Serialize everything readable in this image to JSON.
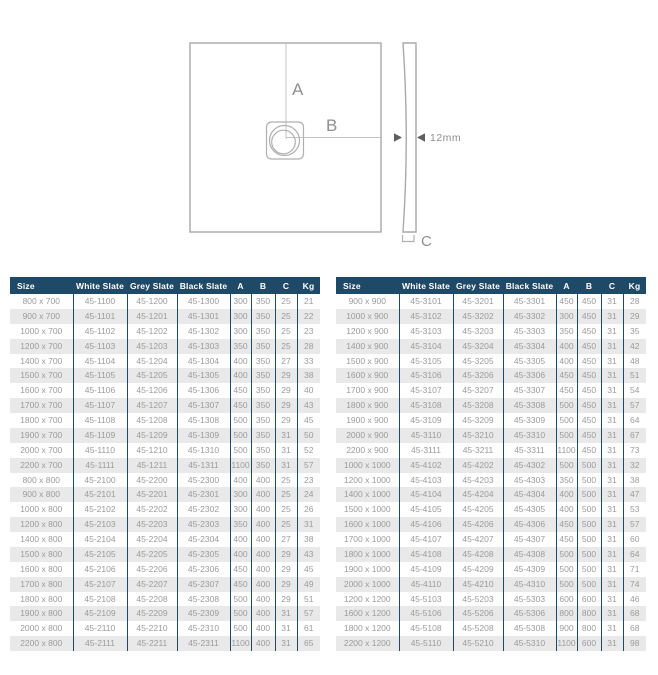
{
  "diagram": {
    "labels": {
      "a": "A",
      "b": "B",
      "c": "C",
      "thickness": "12mm"
    }
  },
  "columns": [
    "Size",
    "White Slate",
    "Grey Slate",
    "Black Slate",
    "A",
    "B",
    "C",
    "Kg"
  ],
  "tables": [
    {
      "id": "table-left",
      "rows": [
        [
          "800 x 700",
          "45-1100",
          "45-1200",
          "45-1300",
          "300",
          "350",
          "25",
          "21"
        ],
        [
          "900 x 700",
          "45-1101",
          "45-1201",
          "45-1301",
          "300",
          "350",
          "25",
          "22"
        ],
        [
          "1000 x 700",
          "45-1102",
          "45-1202",
          "45-1302",
          "300",
          "350",
          "25",
          "23"
        ],
        [
          "1200 x 700",
          "45-1103",
          "45-1203",
          "45-1303",
          "350",
          "350",
          "25",
          "28"
        ],
        [
          "1400 x 700",
          "45-1104",
          "45-1204",
          "45-1304",
          "400",
          "350",
          "27",
          "33"
        ],
        [
          "1500 x 700",
          "45-1105",
          "45-1205",
          "45-1305",
          "400",
          "350",
          "29",
          "38"
        ],
        [
          "1600 x 700",
          "45-1106",
          "45-1206",
          "45-1306",
          "450",
          "350",
          "29",
          "40"
        ],
        [
          "1700 x 700",
          "45-1107",
          "45-1207",
          "45-1307",
          "450",
          "350",
          "29",
          "43"
        ],
        [
          "1800 x 700",
          "45-1108",
          "45-1208",
          "45-1308",
          "500",
          "350",
          "29",
          "45"
        ],
        [
          "1900 x 700",
          "45-1109",
          "45-1209",
          "45-1309",
          "500",
          "350",
          "31",
          "50"
        ],
        [
          "2000 x 700",
          "45-1110",
          "45-1210",
          "45-1310",
          "500",
          "350",
          "31",
          "52"
        ],
        [
          "2200 x 700",
          "45-1111",
          "45-1211",
          "45-1311",
          "1100",
          "350",
          "31",
          "57"
        ],
        [
          "800 x 800",
          "45-2100",
          "45-2200",
          "45-2300",
          "400",
          "400",
          "25",
          "23"
        ],
        [
          "900 x 800",
          "45-2101",
          "45-2201",
          "45-2301",
          "300",
          "400",
          "25",
          "24"
        ],
        [
          "1000 x 800",
          "45-2102",
          "45-2202",
          "45-2302",
          "300",
          "400",
          "25",
          "26"
        ],
        [
          "1200 x 800",
          "45-2103",
          "45-2203",
          "45-2303",
          "350",
          "400",
          "25",
          "31"
        ],
        [
          "1400 x 800",
          "45-2104",
          "45-2204",
          "45-2304",
          "400",
          "400",
          "27",
          "38"
        ],
        [
          "1500 x 800",
          "45-2105",
          "45-2205",
          "45-2305",
          "400",
          "400",
          "29",
          "43"
        ],
        [
          "1600 x 800",
          "45-2106",
          "45-2206",
          "45-2306",
          "450",
          "400",
          "29",
          "45"
        ],
        [
          "1700 x 800",
          "45-2107",
          "45-2207",
          "45-2307",
          "450",
          "400",
          "29",
          "49"
        ],
        [
          "1800 x 800",
          "45-2108",
          "45-2208",
          "45-2308",
          "500",
          "400",
          "29",
          "51"
        ],
        [
          "1900 x 800",
          "45-2109",
          "45-2209",
          "45-2309",
          "500",
          "400",
          "31",
          "57"
        ],
        [
          "2000 x 800",
          "45-2110",
          "45-2210",
          "45-2310",
          "500",
          "400",
          "31",
          "61"
        ],
        [
          "2200 x 800",
          "45-2111",
          "45-2211",
          "45-2311",
          "1100",
          "400",
          "31",
          "65"
        ]
      ]
    },
    {
      "id": "table-right",
      "rows": [
        [
          "900 x 900",
          "45-3101",
          "45-3201",
          "45-3301",
          "450",
          "450",
          "31",
          "28"
        ],
        [
          "1000 x 900",
          "45-3102",
          "45-3202",
          "45-3302",
          "300",
          "450",
          "31",
          "29"
        ],
        [
          "1200 x 900",
          "45-3103",
          "45-3203",
          "45-3303",
          "350",
          "450",
          "31",
          "35"
        ],
        [
          "1400 x 900",
          "45-3104",
          "45-3204",
          "45-3304",
          "400",
          "450",
          "31",
          "42"
        ],
        [
          "1500 x 900",
          "45-3105",
          "45-3205",
          "45-3305",
          "400",
          "450",
          "31",
          "48"
        ],
        [
          "1600 x 900",
          "45-3106",
          "45-3206",
          "45-3306",
          "450",
          "450",
          "31",
          "51"
        ],
        [
          "1700 x 900",
          "45-3107",
          "45-3207",
          "45-3307",
          "450",
          "450",
          "31",
          "54"
        ],
        [
          "1800 x 900",
          "45-3108",
          "45-3208",
          "45-3308",
          "500",
          "450",
          "31",
          "57"
        ],
        [
          "1900 x 900",
          "45-3109",
          "45-3209",
          "45-3309",
          "500",
          "450",
          "31",
          "64"
        ],
        [
          "2000 x 900",
          "45-3110",
          "45-3210",
          "45-3310",
          "500",
          "450",
          "31",
          "67"
        ],
        [
          "2200 x 900",
          "45-3111",
          "45-3211",
          "45-3311",
          "1100",
          "450",
          "31",
          "73"
        ],
        [
          "1000 x 1000",
          "45-4102",
          "45-4202",
          "45-4302",
          "500",
          "500",
          "31",
          "32"
        ],
        [
          "1200 x 1000",
          "45-4103",
          "45-4203",
          "45-4303",
          "350",
          "500",
          "31",
          "38"
        ],
        [
          "1400 x 1000",
          "45-4104",
          "45-4204",
          "45-4304",
          "400",
          "500",
          "31",
          "47"
        ],
        [
          "1500 x 1000",
          "45-4105",
          "45-4205",
          "45-4305",
          "400",
          "500",
          "31",
          "53"
        ],
        [
          "1600 x 1000",
          "45-4106",
          "45-4206",
          "45-4306",
          "450",
          "500",
          "31",
          "57"
        ],
        [
          "1700 x 1000",
          "45-4107",
          "45-4207",
          "45-4307",
          "450",
          "500",
          "31",
          "60"
        ],
        [
          "1800 x 1000",
          "45-4108",
          "45-4208",
          "45-4308",
          "500",
          "500",
          "31",
          "64"
        ],
        [
          "1900 x 1000",
          "45-4109",
          "45-4209",
          "45-4309",
          "500",
          "500",
          "31",
          "71"
        ],
        [
          "2000 x 1000",
          "45-4110",
          "45-4210",
          "45-4310",
          "500",
          "500",
          "31",
          "74"
        ],
        [
          "1200 x 1200",
          "45-5103",
          "45-5203",
          "45-5303",
          "600",
          "600",
          "31",
          "46"
        ],
        [
          "1600 x 1200",
          "45-5106",
          "45-5206",
          "45-5306",
          "800",
          "800",
          "31",
          "68"
        ],
        [
          "1800 x 1200",
          "45-5108",
          "45-5208",
          "45-5308",
          "900",
          "800",
          "31",
          "68"
        ],
        [
          "2200 x 1200",
          "45-5110",
          "45-5210",
          "45-5310",
          "1100",
          "600",
          "31",
          "98"
        ]
      ]
    }
  ],
  "colors": {
    "header_bg": "#1e4a68",
    "row_alt": "#e9e9e9",
    "data_text": "#9b9b9b",
    "diagram_line": "#a9a9a9"
  }
}
